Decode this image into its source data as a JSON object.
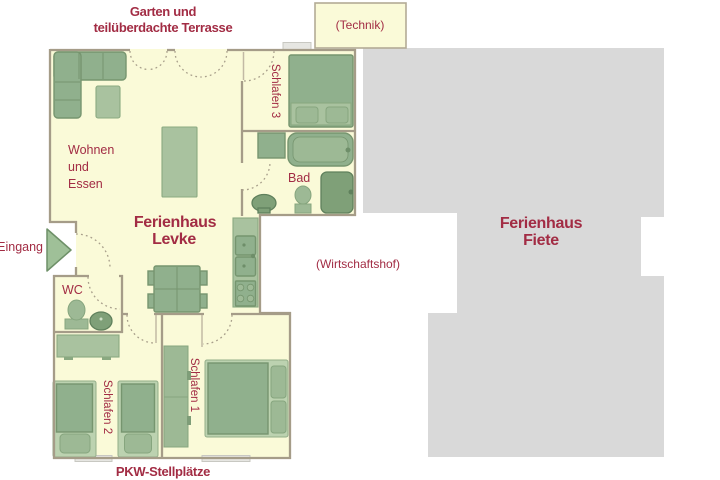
{
  "labels": {
    "garden_1": "Garten und",
    "garden_2": "teilüberdachte Terrasse",
    "technik": "(Technik)",
    "wohnen_1": "Wohnen",
    "wohnen_2": "und",
    "wohnen_3": "Essen",
    "levke_1": "Ferienhaus",
    "levke_2": "Levke",
    "fiete_1": "Ferienhaus",
    "fiete_2": "Fiete",
    "wirtschaftshof": "(Wirtschaftshof)",
    "eingang": "Eingang",
    "wc": "WC",
    "bad": "Bad",
    "schlafen_1": "Schlafen 1",
    "schlafen_2": "Schlafen 2",
    "schlafen_3": "Schlafen 3",
    "pkw": "PKW-Stellplätze"
  },
  "colors": {
    "floor": "#FAFAD8",
    "wall": "#A59C88",
    "building_gray": "#D9D9D9",
    "label_red": "#A22C44",
    "furniture_green": "#90B08D",
    "furniture_light": "#A9C29F",
    "fixture_dark": "#7FA078"
  }
}
